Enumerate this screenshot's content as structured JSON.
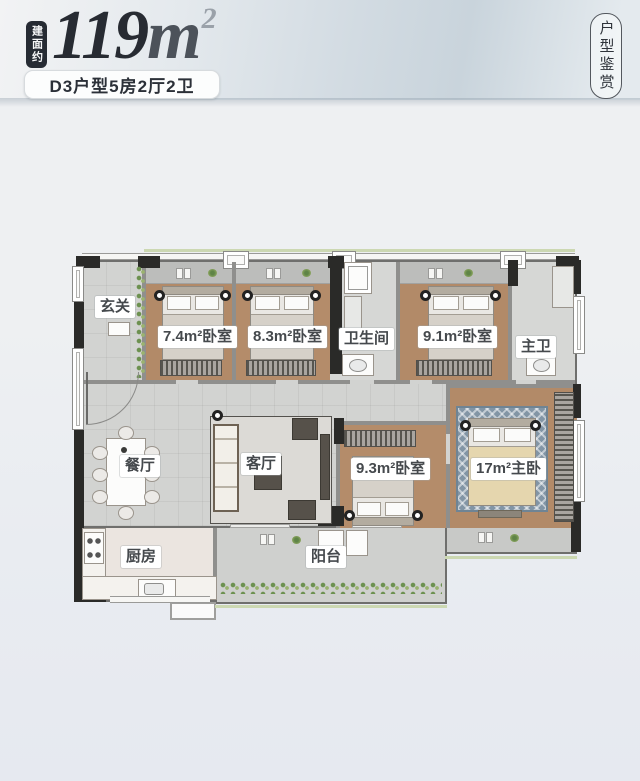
{
  "header": {
    "area_badge": "建面约",
    "area_number": "119",
    "area_unit": "m",
    "area_sup": "2",
    "type_line": "D3户型5房2厅2卫",
    "corner_tag": "户型鉴赏"
  },
  "floorplan": {
    "rooms": {
      "entry": "玄关",
      "bedroom_74": "7.4m²卧室",
      "bedroom_83": "8.3m²卧室",
      "bathroom": "卫生间",
      "bedroom_91": "9.1m²卧室",
      "master_bath": "主卫",
      "dining": "餐厅",
      "living": "客厅",
      "bedroom_93": "9.3m²卧室",
      "master_bedroom": "17m²主卧",
      "kitchen": "厨房",
      "balcony": "阳台"
    }
  },
  "colors": {
    "bedroom_floor": "#b28a68",
    "hall_floor": "#d2d3d1",
    "kitchen_floor": "#ebe5e0",
    "wall_dark": "#2a2a28",
    "wall_gray": "#8f8f8d",
    "rug_blue": "#8295a5",
    "plant_green": "#6d9150",
    "badge_bg": "#262b33",
    "title_color": "#272b32",
    "page_band": "#cfd9e0"
  }
}
